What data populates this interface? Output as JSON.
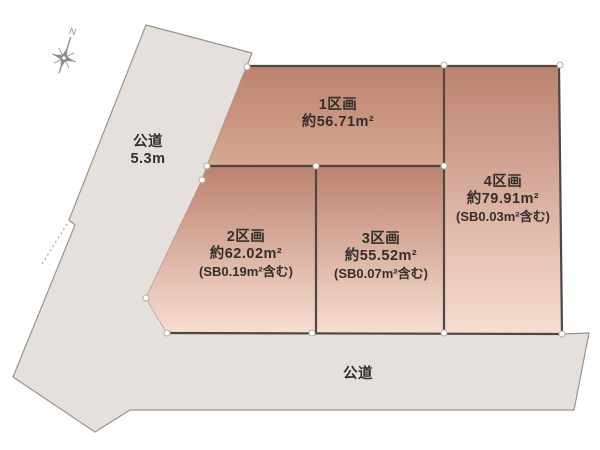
{
  "compass": {
    "north_label": "N"
  },
  "roads": {
    "left": {
      "label": "公道",
      "width": "5.3m"
    },
    "bottom": {
      "label": "公道"
    }
  },
  "parcels": [
    {
      "name": "1区画",
      "area": "約56.71m²"
    },
    {
      "name": "2区画",
      "area": "約62.02m²",
      "note": "(SB0.19m²含む)"
    },
    {
      "name": "3区画",
      "area": "約55.52m²",
      "note": "(SB0.07m²含む)"
    },
    {
      "name": "4区画",
      "area": "約79.91m²",
      "note": "(SB0.03m²含む)"
    }
  ],
  "colors": {
    "parcel_top": "#bc8270",
    "parcel_light": "#f7ded1",
    "parcel_mid": "#d7a78f",
    "road_fill": "#e5e0db",
    "outline": "#9b948e",
    "parcel_border": "#4e4743",
    "text": "#33302c",
    "compass": "#8e8e8e"
  }
}
